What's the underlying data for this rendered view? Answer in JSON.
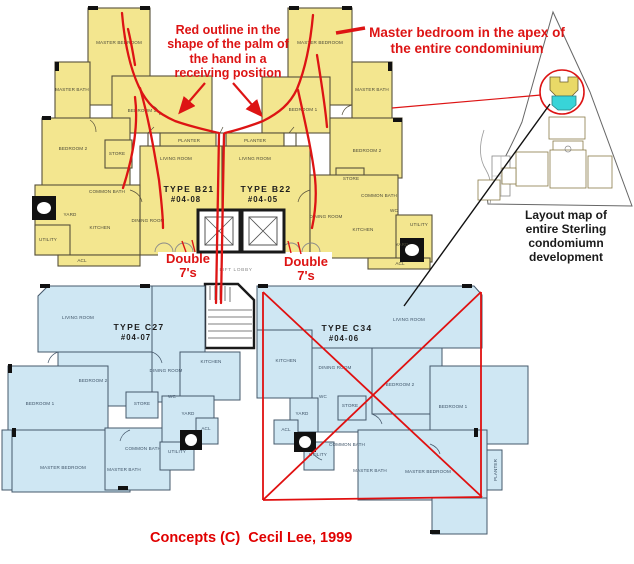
{
  "annotations": {
    "palm_note": "Red outline in the shape of the palm of the hand in a receiving position",
    "apex_note": "Master bedroom in the apex of the entire condominium",
    "double_sevens_left": "Double 7's",
    "double_sevens_right": "Double 7's",
    "map_caption": "Layout map of entire Sterling condomiumn development",
    "copyright": "Concepts (C)  Cecil Lee, 1999"
  },
  "units": {
    "b21": {
      "type": "TYPE B21",
      "number": "#04-08"
    },
    "b22": {
      "type": "TYPE B22",
      "number": "#04-05"
    },
    "c27": {
      "type": "TYPE C27",
      "number": "#04-07"
    },
    "c34": {
      "type": "TYPE C34",
      "number": "#04-06"
    }
  },
  "rooms": {
    "master_bedroom": "MASTER BEDROOM",
    "master_bath": "MASTER BATH",
    "bedroom_1": "BEDROOM 1",
    "bedroom_2": "BEDROOM 2",
    "living_room": "LIVING ROOM",
    "dining_room": "DINING ROOM",
    "kitchen": "KITCHEN",
    "common_bath": "COMMON BATH",
    "store": "STORE",
    "yard": "YARD",
    "utility": "UTILITY",
    "wc": "WC",
    "acl": "ACL",
    "planter": "PLANTER",
    "lift_lobby": "LIFT LOBBY"
  },
  "colors": {
    "upper_plan_fill": "#f3e68f",
    "lower_plan_fill": "#cfe7f3",
    "annotation_red": "#dd1414",
    "map_building_yellow": "#e9d967",
    "map_building_cyan": "#38d4d8"
  }
}
